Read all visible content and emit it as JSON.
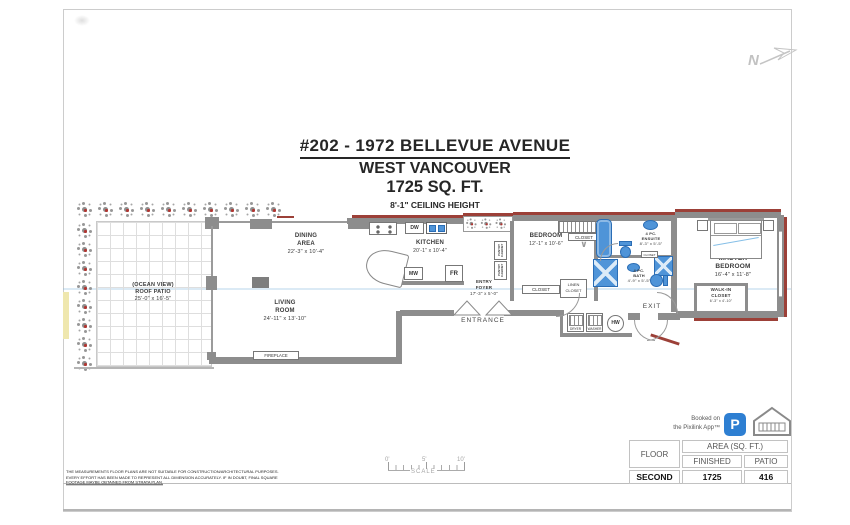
{
  "header": {
    "north_letter": "N"
  },
  "title": {
    "line1": "#202 - 1972 BELLEVUE AVENUE",
    "line2": "WEST VANCOUVER",
    "line3": "1725 SQ. FT.",
    "line4": "8'-1\" CEILING HEIGHT"
  },
  "plan": {
    "patio": {
      "l1": "(OCEAN VIEW)",
      "l2": "ROOF PATIO",
      "l3": "25'-0\" x 16'-5\""
    },
    "dining": {
      "l1": "DINING",
      "l2": "AREA",
      "l3": "22'-3\" x 10'-4\""
    },
    "kitchen": {
      "l1": "KITCHEN",
      "l2": "20'-1\" x 10'-4\""
    },
    "living": {
      "l1": "LIVING",
      "l2": "ROOM",
      "l3": "24'-11\" x 13'-10\""
    },
    "entry": {
      "l1": "ENTRY",
      "l2": "FOYER",
      "l3": "17'-3\" x 5'-0\""
    },
    "bedroom": {
      "l1": "BEDROOM",
      "l2": "12'-1\" x 10'-6\""
    },
    "master": {
      "l1": "MASTER",
      "l2": "BEDROOM",
      "l3": "16'-4\" x 11'-8\""
    },
    "walkin": {
      "l1": "WALK-IN",
      "l2": "CLOSET",
      "l3": "6'-3\" x 4'-10\""
    },
    "ensuite": {
      "l1": "4 PC.",
      "l2": "ENSUITE",
      "l3": "8'-3\" x 5'-5\""
    },
    "bath": {
      "l1": "4 PC.",
      "l2": "BATH",
      "l3": "4'-9\" x 5'-5\""
    },
    "labels": {
      "entrance": "ENTRANCE",
      "exit": "EXIT",
      "fireplace": "FIREPLACE",
      "closet": "CLOSET",
      "linen1": "LINEN",
      "linen2": "CLOSET",
      "pantry": "PANTRY CABINET",
      "dw": "DW",
      "mw": "MW",
      "fr": "FR",
      "hw": "HW",
      "dryer": "DRYER",
      "washer": "WASHER"
    }
  },
  "scalebar": {
    "t0": "0'",
    "t1": "5'",
    "t2": "10'",
    "label": "SCALE"
  },
  "summary_table": {
    "floor_header": "FLOOR",
    "area_header": "AREA (SQ. FT.)",
    "col1": "FINISHED",
    "col2": "PATIO",
    "floor": "SECOND",
    "finished": "1725",
    "patio": "416"
  },
  "branding": {
    "line1": "Booked on",
    "line2": "the Pixilink App™",
    "app_letter": "P"
  },
  "disclaimer": {
    "l1": "THE MEASUREMENTS FLOOR PLANS ARE NOT SUITABLE FOR CONSTRUCTION/ARCHITECTURAL PURPOSES.",
    "l2": "EVERY EFFORT HAS BEEN MADE TO REPRESENT ALL DIMENSION ACCURATELY. IF IN DOUBT, FINAL SQUARE",
    "l3": "FOOTAGE MAYBE OBTAINED FROM STRATA PLAN."
  },
  "colors": {
    "wall_gray": "#8d8d8d",
    "accent_red": "#9c4038",
    "fixture_blue": "#4f94d8",
    "pixilink_blue": "#2e7fd2"
  },
  "decor": {
    "plants_top": 10,
    "plants_left": 8,
    "plants_entry": 3
  }
}
